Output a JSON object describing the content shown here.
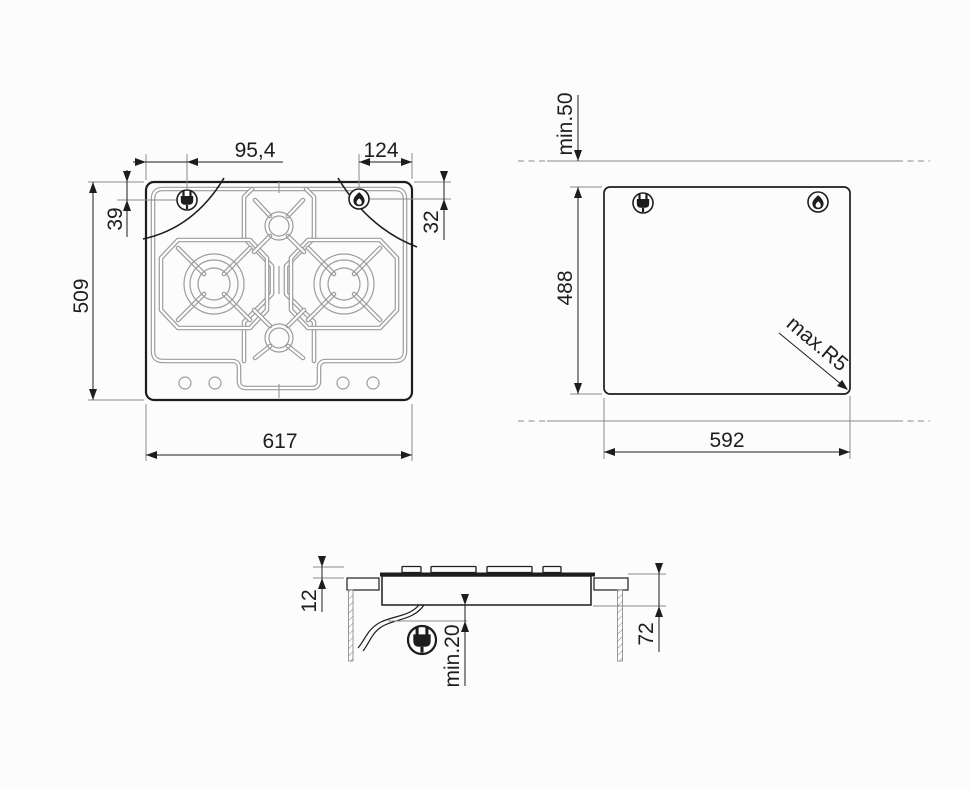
{
  "diagram": {
    "background": "#fcfcfc",
    "line_color": "#1d1d1d",
    "pattern_color": "#9c9c9c",
    "views": {
      "hob_top_view": {
        "label": "hob top view",
        "dimensions": {
          "plug_offset_x": "95,4",
          "flame_offset_x": "124",
          "plug_offset_y": "39",
          "flame_offset_y": "32",
          "overall_depth": "509",
          "overall_width": "617"
        },
        "icons": [
          "plug-icon",
          "flame-icon"
        ],
        "burner_count": 4,
        "knob_count": 4
      },
      "worktop_cutout_view": {
        "label": "worktop cutout view",
        "dimensions": {
          "rear_clearance": "min.50",
          "cutout_depth": "488",
          "cutout_width": "592",
          "corner_radius": "max.R5"
        },
        "icons": [
          "plug-icon",
          "flame-icon"
        ]
      },
      "side_section_view": {
        "label": "side section view",
        "dimensions": {
          "height_above_worktop": "12",
          "built_in_depth": "72",
          "under_clearance": "min.20"
        },
        "icons": [
          "plug-icon"
        ]
      }
    }
  }
}
